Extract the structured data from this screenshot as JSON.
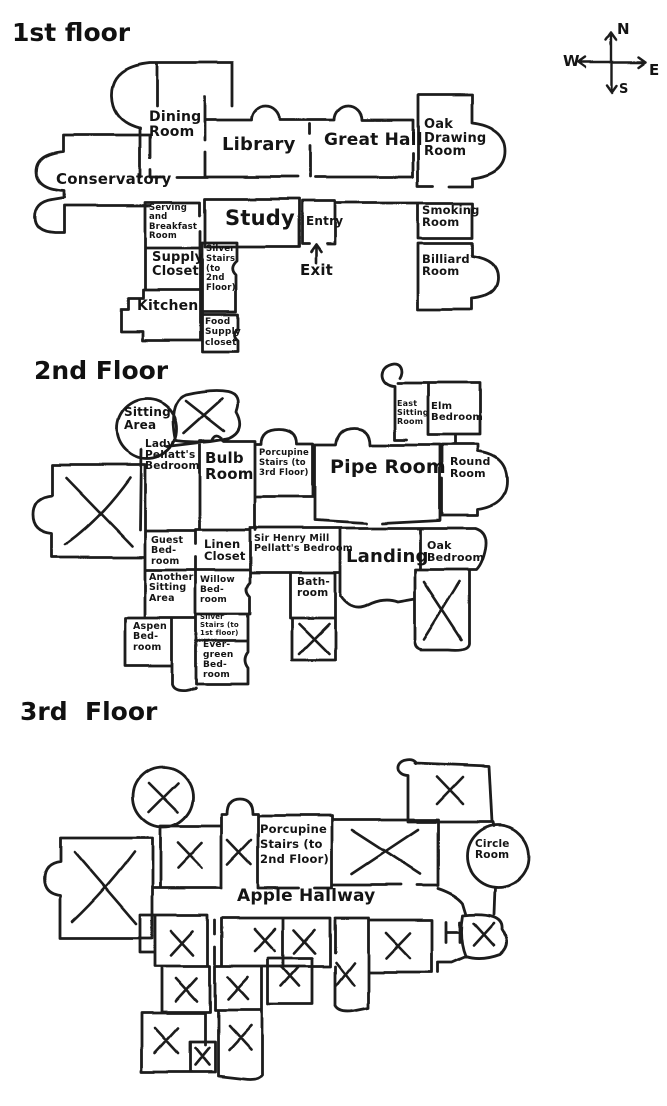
{
  "compass": {
    "north": "N",
    "west": "W",
    "east": "E",
    "south": "S"
  },
  "floor1": {
    "title": "1st floor",
    "rooms": {
      "conservatory": "Conservatory",
      "dining": "Dining\nRoom",
      "library": "Library",
      "great_hall": "Great Hall",
      "oak_drawing": "Oak\nDrawing\nRoom",
      "serving_breakfast": "Serving\nand\nBreakfast\nRoom",
      "study": "Study",
      "entry": "Entry",
      "smoking": "Smoking\nRoom",
      "supply_closet": "Supply\nCloset",
      "silver_stairs_up": "Silver\nStairs\n(to\n2nd\nFloor)",
      "billiard": "Billiard\nRoom",
      "kitchen": "Kitchen",
      "food_supply": "Food\nSupply\ncloset",
      "exit": "Exit"
    }
  },
  "floor2": {
    "title": "2nd Floor",
    "rooms": {
      "sitting_area": "Sitting\nArea",
      "lady_pellatts": "Lady\nPellatt's\nBedroom",
      "bulb": "Bulb\nRoom",
      "porcupine_stairs_up": "Porcupine\nStairs (to\n3rd Floor)",
      "pipe": "Pipe Room",
      "east_sitting": "East\nSitting\nRoom",
      "elm": "Elm\nBedroom",
      "round": "Round\nRoom",
      "guest": "Guest\nBed-\nroom",
      "linen": "Linen\nCloset",
      "sir_henry": "Sir Henry Mill\nPellatt's Bedroom",
      "landing": "Landing",
      "oak": "Oak\nBedroom",
      "another_sitting": "Another\nSitting\nArea",
      "willow": "Willow\nBed-\nroom",
      "bath": "Bath-\nroom",
      "aspen": "Aspen\nBed-\nroom",
      "silver_stairs_down": "Silver\nStairs (to\n1st floor)",
      "evergreen": "Ever-\ngreen\nBed-\nroom"
    }
  },
  "floor3": {
    "title": "3rd  Floor",
    "rooms": {
      "porcupine_stairs_down": "Porcupine\nStairs (to\n2nd Floor)",
      "circle": "Circle\nRoom",
      "apple_hallway": "Apple Hallway"
    }
  }
}
